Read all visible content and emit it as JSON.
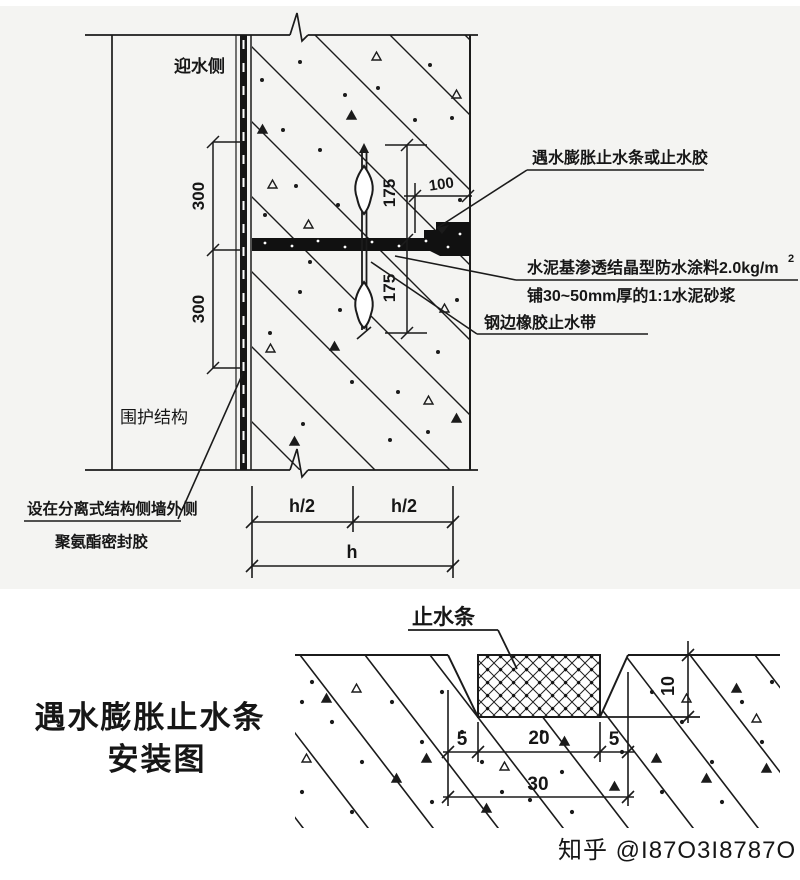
{
  "page": {
    "ink": "#1b1b1b",
    "paper_tint": "#f3f3f1",
    "watermark_color": "#b5b5b5"
  },
  "top_diagram": {
    "side_label": "迎水侧",
    "wall_label": "围护结构",
    "dims": {
      "d300_upper": "300",
      "d300_lower": "300",
      "d175_upper": "175",
      "d175_lower": "175",
      "d100": "100",
      "h_half_left": "h/2",
      "h_half_right": "h/2",
      "h_total": "h"
    },
    "annotations": {
      "swelling_strip": "遇水膨胀止水条或止水胶",
      "cement_coating": "水泥基渗透结晶型防水涂料2.0kg/m",
      "cement_coating_sup": "2",
      "mortar": "铺30~50mm厚的1:1水泥砂浆",
      "steel_edge_waterstop": "钢边橡胶止水带",
      "sealant_line1": "设在分离式结构侧墙外侧",
      "sealant_line2": "聚氨酯密封胶"
    }
  },
  "bottom_diagram": {
    "strip_label": "止水条",
    "dims": {
      "left_5": "5",
      "center_20": "20",
      "right_5": "5",
      "total_30": "30",
      "depth_10": "10"
    }
  },
  "caption": {
    "line1": "遇水膨胀止水条",
    "line2": "安装图"
  },
  "watermark": {
    "text": "知乎 @I87O3I8787O"
  }
}
